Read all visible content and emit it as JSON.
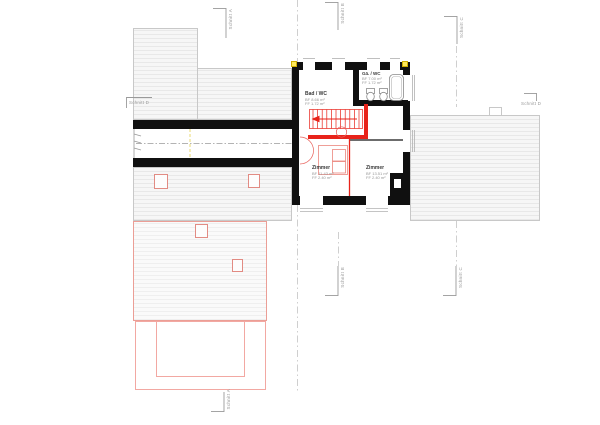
{
  "drawing": {
    "type": "floor-plan",
    "section_labels": {
      "a": "Schnitt A",
      "b": "Schnitt B",
      "c": "Schnitt C",
      "d": "Schnitt D"
    },
    "rooms": [
      {
        "name": "Bad / WC",
        "line1": "BF 8.66 m²",
        "line2": "FF 1.72 m²"
      },
      {
        "name": "Gä. / WC",
        "line1": "BF 7.00 m²",
        "line2": "FF 1.72 m²"
      },
      {
        "name": "Zimmer",
        "line1": "BF 11.43 m²",
        "line2": "FF 2.40 m²"
      },
      {
        "name": "Zimmer",
        "line1": "BF 13.51 m²",
        "line2": "FF 2.40 m²"
      }
    ],
    "colors": {
      "wall_black": "#101010",
      "new_construction_red": "#e8231a",
      "roof_fill": "#f6f6f6",
      "roof_line": "#c8c8c8",
      "pink_outline": "#f2a8a2",
      "section_gray": "#9a9a9a",
      "marker_yellow": "#ffe95a"
    }
  }
}
